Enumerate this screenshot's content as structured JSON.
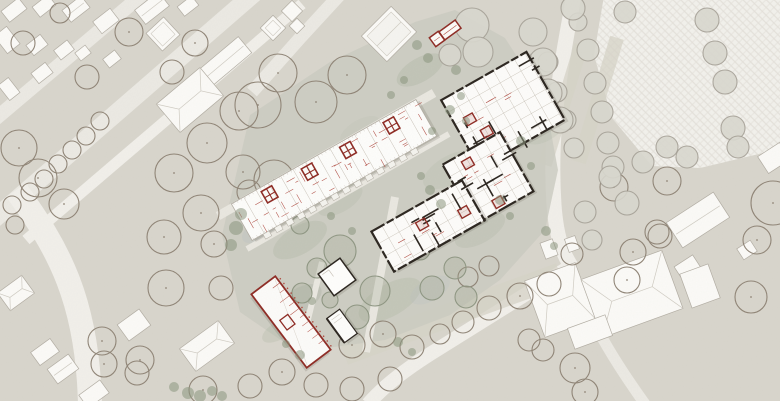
{
  "meta": {
    "description": "architectural site plan, no visible text",
    "width": 780,
    "height": 401
  },
  "palette": {
    "bg": "#d8d5cc",
    "road": "#ebe9e3",
    "roadLight": "#f1efea",
    "path": "#e9e7e0",
    "bldgFill": "#fbfaf7",
    "bldgStroke": "#b2ada3",
    "roofLine": "#cfcbc2",
    "treeBrown": "#8f8476",
    "treeGray": "#a5a096",
    "treeGreenFill": "#9aa38c",
    "treeGreenStroke": "#8e9682",
    "shrub": "#8b967e",
    "courtyard": "#cacbc0",
    "stripe": "#d5d3c7",
    "plaza": "#f2f1ec",
    "plazaLine": "#e3e0d9",
    "redWall": "#8e2b24",
    "redLine": "#b04c42",
    "black": "#2b251f",
    "lightLine": "#c5beb3"
  },
  "roads": [
    {
      "name": "street-a",
      "d": "M 258,-10 L -22,233",
      "w": 18,
      "c": "road"
    },
    {
      "name": "street-b",
      "d": "M 302,4 L 26,240",
      "w": 11,
      "c": "roadLight"
    },
    {
      "name": "street-c",
      "d": "M 150,-12 L -32,142",
      "w": 14,
      "c": "road"
    },
    {
      "name": "street-cross",
      "d": "M 346,-12 L 300,38 L 252,92",
      "w": 13,
      "c": "road"
    },
    {
      "name": "street-curve",
      "d": "M 16,190 C 58,248 88,300 90,406",
      "w": 24,
      "c": "roadLight"
    },
    {
      "name": "street-right",
      "d": "M 575,-10 C 560,70 549,130 554,205 C 557,245 566,258 571,266",
      "w": 15,
      "c": "roadLight"
    },
    {
      "name": "street-sw",
      "d": "M 571,266 L 430,354 C 405,370 385,385 368,404",
      "w": 14,
      "c": "roadLight"
    },
    {
      "name": "street-se",
      "d": "M 571,266 C 586,315 612,358 645,404",
      "w": 11,
      "c": "road"
    }
  ],
  "paths": [
    {
      "d": "M 218,216 L 434,93",
      "w": 9
    },
    {
      "d": "M 247,249 L 449,134",
      "w": 6
    },
    {
      "d": "M 395,197 L 366,352",
      "w": 8
    },
    {
      "d": "M 322,262 L 300,352",
      "w": 6
    }
  ],
  "plaza": {
    "points": "604,-4 784,-4 784,148 742,158 700,168 652,166 612,118 594,55"
  },
  "stripes": [
    [
      563,
      105,
      14,
      125,
      17
    ],
    [
      598,
      100,
      14,
      130,
      17
    ],
    [
      452,
      314,
      230,
      24,
      -20
    ]
  ],
  "courtyard": {
    "points": "222,235 250,115 330,62 415,22 455,10 505,38 545,100 558,170 545,230 500,280 450,315 385,340 298,352 240,312"
  },
  "splotches": [
    [
      300,
      240,
      30,
      14,
      -30,
      "#aab39e",
      0.3
    ],
    [
      390,
      300,
      35,
      16,
      -30,
      "#aab39e",
      0.28
    ],
    [
      450,
      170,
      30,
      14,
      -30,
      "#b2baa6",
      0.25
    ],
    [
      340,
      200,
      25,
      12,
      -30,
      "#aab39e",
      0.22
    ],
    [
      480,
      230,
      28,
      13,
      -30,
      "#aab39e",
      0.25
    ],
    [
      420,
      70,
      26,
      12,
      -30,
      "#a5ae9a",
      0.3
    ],
    [
      300,
      300,
      24,
      12,
      -30,
      "#9fa898",
      0.25
    ],
    [
      260,
      230,
      20,
      10,
      -30,
      "#b8c0c4",
      0.25
    ],
    [
      430,
      290,
      22,
      11,
      -30,
      "#b5bfc2",
      0.22
    ],
    [
      360,
      130,
      22,
      10,
      -30,
      "#b8c0ae",
      0.2
    ],
    [
      505,
      95,
      20,
      10,
      -30,
      "#aeb6a2",
      0.25
    ],
    [
      280,
      330,
      20,
      9,
      -30,
      "#a9b29d",
      0.25
    ],
    [
      545,
      130,
      22,
      11,
      -30,
      "#aeb6a2",
      0.22
    ]
  ],
  "existing_buildings": [
    [
      14,
      10,
      22,
      14,
      -38,
      "p"
    ],
    [
      44,
      6,
      20,
      13,
      -38,
      "p"
    ],
    [
      76,
      9,
      24,
      15,
      -38,
      "r"
    ],
    [
      106,
      21,
      22,
      15,
      -38,
      "p"
    ],
    [
      152,
      8,
      30,
      18,
      -38,
      "r"
    ],
    [
      188,
      6,
      18,
      12,
      -38,
      "p"
    ],
    [
      7,
      40,
      16,
      22,
      -38,
      "p"
    ],
    [
      37,
      45,
      18,
      13,
      -38,
      "p"
    ],
    [
      64,
      50,
      17,
      12,
      -38,
      "p"
    ],
    [
      83,
      53,
      13,
      10,
      -38,
      "p"
    ],
    [
      42,
      73,
      18,
      13,
      -38,
      "p"
    ],
    [
      9,
      89,
      13,
      19,
      -38,
      "p"
    ],
    [
      112,
      59,
      15,
      11,
      -38,
      "p"
    ],
    [
      163,
      34,
      24,
      24,
      -43,
      "s"
    ],
    [
      292,
      11,
      15,
      15,
      -45,
      "p"
    ],
    [
      273,
      28,
      18,
      18,
      -45,
      "s"
    ],
    [
      297,
      26,
      11,
      11,
      -45,
      "p"
    ],
    [
      389,
      34,
      42,
      36,
      -45,
      "g"
    ],
    [
      222,
      64,
      60,
      21,
      -40,
      "r"
    ],
    [
      190,
      100,
      57,
      37,
      -40,
      "h"
    ],
    [
      16,
      293,
      30,
      22,
      -36,
      "h"
    ],
    [
      45,
      352,
      24,
      16,
      -36,
      "p"
    ],
    [
      63,
      369,
      26,
      18,
      -36,
      "r"
    ],
    [
      134,
      325,
      27,
      20,
      -36,
      "p"
    ],
    [
      207,
      346,
      48,
      28,
      -36,
      "h"
    ],
    [
      94,
      394,
      26,
      16,
      -36,
      "p"
    ],
    [
      698,
      220,
      56,
      30,
      -33,
      "r"
    ],
    [
      688,
      268,
      22,
      17,
      -33,
      "p"
    ],
    [
      747,
      250,
      16,
      13,
      -33,
      "p"
    ],
    [
      774,
      158,
      26,
      20,
      -33,
      "p"
    ],
    [
      560,
      300,
      54,
      60,
      -20,
      "h"
    ],
    [
      632,
      294,
      86,
      62,
      -20,
      "h"
    ],
    [
      700,
      286,
      30,
      36,
      -20,
      "p"
    ],
    [
      549,
      249,
      13,
      17,
      -20,
      "p"
    ],
    [
      572,
      244,
      11,
      14,
      -20,
      "p"
    ],
    [
      590,
      332,
      40,
      22,
      -20,
      "p"
    ]
  ],
  "trees": {
    "b": [
      [
        129,
        32,
        14
      ],
      [
        195,
        43,
        13
      ],
      [
        87,
        77,
        12
      ],
      [
        172,
        72,
        12
      ],
      [
        23,
        43,
        12
      ],
      [
        60,
        13,
        10
      ],
      [
        239,
        111,
        19
      ],
      [
        207,
        143,
        20
      ],
      [
        174,
        173,
        19
      ],
      [
        243,
        172,
        17
      ],
      [
        19,
        148,
        18
      ],
      [
        38,
        178,
        19
      ],
      [
        64,
        204,
        15
      ],
      [
        100,
        121,
        9
      ],
      [
        86,
        136,
        9
      ],
      [
        72,
        150,
        9
      ],
      [
        58,
        164,
        9
      ],
      [
        44,
        179,
        9
      ],
      [
        30,
        192,
        9
      ],
      [
        278,
        73,
        19
      ],
      [
        347,
        75,
        19
      ],
      [
        258,
        105,
        23
      ],
      [
        316,
        102,
        21
      ],
      [
        274,
        180,
        20
      ],
      [
        249,
        192,
        12
      ],
      [
        12,
        205,
        9
      ],
      [
        15,
        225,
        9
      ],
      [
        164,
        237,
        17
      ],
      [
        201,
        213,
        18
      ],
      [
        214,
        244,
        13
      ],
      [
        166,
        288,
        18
      ],
      [
        221,
        288,
        12
      ],
      [
        140,
        360,
        14
      ],
      [
        137,
        373,
        12
      ],
      [
        102,
        341,
        14
      ],
      [
        104,
        364,
        13
      ],
      [
        203,
        390,
        14
      ],
      [
        250,
        386,
        12
      ],
      [
        282,
        372,
        13
      ],
      [
        316,
        385,
        12
      ],
      [
        352,
        389,
        12
      ],
      [
        390,
        379,
        12
      ],
      [
        352,
        345,
        13
      ],
      [
        383,
        334,
        13
      ],
      [
        412,
        347,
        12
      ],
      [
        440,
        334,
        10
      ],
      [
        463,
        322,
        11
      ],
      [
        489,
        308,
        12
      ],
      [
        520,
        296,
        13
      ],
      [
        549,
        284,
        12
      ],
      [
        468,
        277,
        10
      ],
      [
        489,
        266,
        10
      ],
      [
        529,
        340,
        11
      ],
      [
        543,
        350,
        11
      ],
      [
        575,
        368,
        15
      ],
      [
        585,
        392,
        13
      ],
      [
        633,
        252,
        13
      ],
      [
        627,
        280,
        13
      ],
      [
        660,
        236,
        12
      ],
      [
        572,
        254,
        11
      ],
      [
        751,
        297,
        16
      ],
      [
        773,
        203,
        22
      ],
      [
        757,
        240,
        14
      ],
      [
        614,
        187,
        14
      ],
      [
        657,
        232,
        12
      ],
      [
        667,
        181,
        14
      ]
    ],
    "g": [
      [
        578,
        22,
        9
      ],
      [
        588,
        50,
        11
      ],
      [
        595,
        83,
        11
      ],
      [
        602,
        112,
        11
      ],
      [
        608,
        143,
        11
      ],
      [
        613,
        167,
        11
      ],
      [
        625,
        12,
        11
      ],
      [
        548,
        62,
        10
      ],
      [
        557,
        92,
        10
      ],
      [
        566,
        120,
        10
      ],
      [
        574,
        148,
        10
      ],
      [
        707,
        20,
        12
      ],
      [
        715,
        53,
        12
      ],
      [
        725,
        82,
        12
      ],
      [
        733,
        128,
        12
      ],
      [
        738,
        147,
        11
      ],
      [
        687,
        157,
        11
      ],
      [
        667,
        147,
        11
      ],
      [
        643,
        162,
        11
      ],
      [
        472,
        25,
        17
      ],
      [
        478,
        52,
        15
      ],
      [
        450,
        55,
        11
      ],
      [
        533,
        32,
        14
      ],
      [
        543,
        62,
        14
      ],
      [
        548,
        93,
        14
      ],
      [
        573,
        8,
        12
      ],
      [
        560,
        120,
        13
      ],
      [
        610,
        177,
        11
      ],
      [
        627,
        203,
        12
      ],
      [
        585,
        212,
        11
      ],
      [
        592,
        240,
        10
      ]
    ],
    "c": [
      [
        340,
        251,
        16
      ],
      [
        375,
        291,
        15
      ],
      [
        357,
        317,
        12
      ],
      [
        317,
        268,
        10
      ],
      [
        302,
        293,
        10
      ],
      [
        432,
        288,
        12
      ],
      [
        455,
        268,
        11
      ],
      [
        466,
        297,
        11
      ],
      [
        420,
        250,
        10
      ],
      [
        300,
        225,
        9
      ],
      [
        283,
        310,
        9
      ],
      [
        330,
        300,
        8
      ]
    ]
  },
  "shrubs": [
    [
      188,
      393,
      6
    ],
    [
      200,
      396,
      6
    ],
    [
      212,
      391,
      5
    ],
    [
      222,
      396,
      5
    ],
    [
      174,
      387,
      5
    ],
    [
      236,
      228,
      7
    ],
    [
      241,
      214,
      6
    ],
    [
      231,
      245,
      6
    ],
    [
      300,
      355,
      5
    ],
    [
      286,
      344,
      4
    ],
    [
      398,
      342,
      5
    ],
    [
      412,
      352,
      4
    ],
    [
      430,
      190,
      5
    ],
    [
      441,
      204,
      5
    ],
    [
      421,
      176,
      4
    ],
    [
      450,
      110,
      5
    ],
    [
      461,
      96,
      4
    ],
    [
      432,
      131,
      4
    ],
    [
      500,
      200,
      5
    ],
    [
      510,
      216,
      4
    ],
    [
      352,
      231,
      4
    ],
    [
      331,
      216,
      4
    ],
    [
      312,
      301,
      4
    ],
    [
      456,
      70,
      5
    ],
    [
      466,
      121,
      4
    ],
    [
      521,
      141,
      5
    ],
    [
      531,
      166,
      4
    ],
    [
      546,
      231,
      5
    ],
    [
      554,
      246,
      4
    ],
    [
      417,
      45,
      5
    ],
    [
      428,
      58,
      5
    ],
    [
      404,
      80,
      4
    ],
    [
      391,
      95,
      4
    ]
  ],
  "bar_building": {
    "cx": 334,
    "cy": 170,
    "w": 212,
    "h": 42,
    "rot": -29.5,
    "units": 15,
    "cores": [
      -68,
      -22,
      22,
      72
    ],
    "balcony": {
      "from": -90,
      "to": 90,
      "step": 13,
      "w": 7,
      "h": 5.5
    }
  },
  "complex_wings": [
    {
      "cx": 503,
      "cy": 110,
      "w": 98,
      "h": 78,
      "rot": -29.5,
      "seed": 7
    },
    {
      "cx": 488,
      "cy": 178,
      "w": 66,
      "h": 68,
      "rot": -29.5,
      "seed": 13
    },
    {
      "cx": 428,
      "cy": 226,
      "w": 104,
      "h": 46,
      "rot": -29.5,
      "seed": 21
    }
  ],
  "red_building": {
    "cx": 291,
    "cy": 322,
    "w": 92,
    "h": 30,
    "rot": 53
  },
  "pavilion": {
    "cx": 337,
    "cy": 277,
    "w": 27,
    "h": 27,
    "rot": -36
  },
  "kiosk": {
    "cx": 342,
    "cy": 326,
    "w": 16,
    "h": 30,
    "rot": -36
  },
  "hut": {
    "main": [
      450,
      30,
      20,
      10,
      -36
    ],
    "annex": [
      437,
      39,
      11,
      11,
      -36
    ]
  }
}
